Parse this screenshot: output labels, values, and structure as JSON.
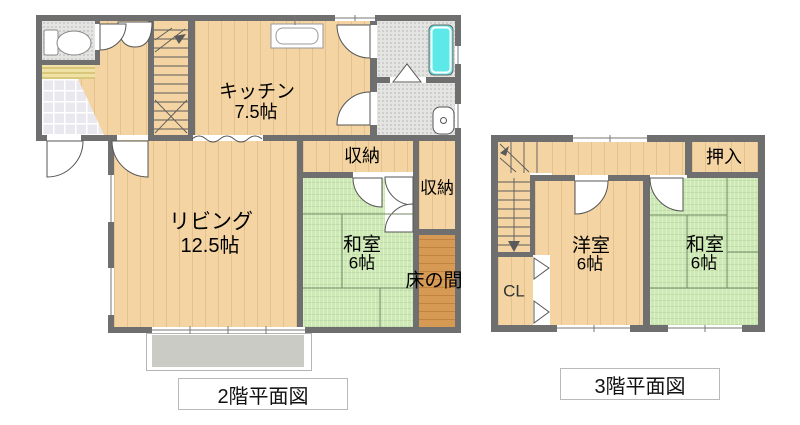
{
  "floor2": {
    "caption": "2階平面図",
    "rooms": {
      "kitchen": {
        "label": "キッチン",
        "size": "7.5帖"
      },
      "living": {
        "label": "リビング",
        "size": "12.5帖"
      },
      "storage_top": {
        "label": "収納"
      },
      "storage_side": {
        "label": "収納"
      },
      "washitsu": {
        "label": "和室",
        "size": "6帖"
      },
      "tokonoma": {
        "label": "床の間"
      }
    }
  },
  "floor3": {
    "caption": "3階平面図",
    "rooms": {
      "western": {
        "label": "洋室",
        "size": "6帖"
      },
      "washitsu": {
        "label": "和室",
        "size": "6帖"
      },
      "oshiire": {
        "label": "押入"
      },
      "closet": {
        "label": "CL"
      }
    }
  },
  "colors": {
    "wall": "#6f6f6f",
    "wood": "#f3d4a2",
    "tatami": "#cde9b4",
    "tokonoma": "#d79a55",
    "tub": "#5ee9e9",
    "balcony": "#cbcbc6",
    "tile": "#e8e8ee",
    "speckle": "#e4e4e2",
    "mat": "#f0e2a4",
    "line": "#555555",
    "capborder": "#b9b9b9"
  }
}
